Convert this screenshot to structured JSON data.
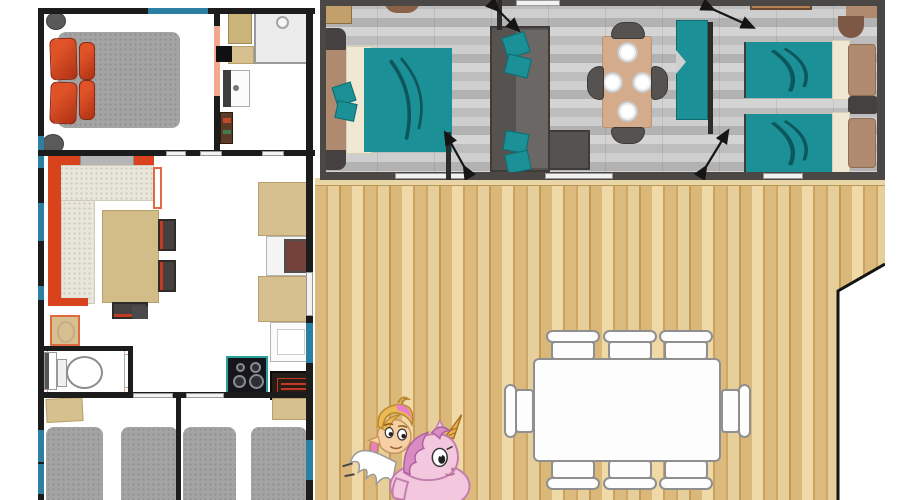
{
  "meta": {
    "type": "floor-plan",
    "subject": "mobile home / lodge floor plan with two units, wooden terrace and cartoon unicorn mascot",
    "visible_text": "none (tiny illegible red label on kitchen oven sign)"
  },
  "colors": {
    "wall": "#1c1c1c",
    "wall_gray": "#4b4744",
    "inner_wall": "#2e2c2a",
    "window_blue": "#2b7fa3",
    "salmon": "#f2a88e",
    "accent_orange": "#d8421c",
    "pillow_red": "#ae3114",
    "teal": "#1b9096",
    "teal_dark": "#0c565c",
    "beige": "#d6c08f",
    "beige_border": "#b7a06b",
    "tan_table": "#d4ac8c",
    "brown": "#b08a6e",
    "brown_dark": "#7d5844",
    "cream": "#f0e8d2",
    "sofa_gray": "#56524f",
    "furniture_dark": "#454140",
    "mattress_gray": "#a4a4a4",
    "cushion_light": "#e9e6dc",
    "steps_brown": "#b58255",
    "deck_mid": "#d9b87a",
    "unicorn_pink": "#f3c8de",
    "unicorn_mane": "#d98cc3",
    "hair_blonde": "#ecba54",
    "hair_pink": "#e87fc8",
    "skin": "#f6d0a4",
    "horn_gold": "#f0b358"
  },
  "floor_plan": {
    "left_unit": {
      "rooms": [
        {
          "name": "master bedroom",
          "furniture": [
            "double bed with red pillows",
            "2 round stools"
          ]
        },
        {
          "name": "shower room",
          "furniture": [
            "shower tray",
            "cabinet",
            "wash basin"
          ]
        },
        {
          "name": "living room",
          "furniture": [
            "orange corner sofa",
            "dining table",
            "3 chairs",
            "radiator"
          ]
        },
        {
          "name": "kitchen",
          "furniture": [
            "fridge",
            "worktop",
            "sink",
            "hob with 4 burners",
            "oven with red sign"
          ]
        },
        {
          "name": "wc",
          "furniture": [
            "toilet",
            "small basin"
          ]
        },
        {
          "name": "kids bedroom A",
          "furniture": [
            "2 single beds",
            "nightstand"
          ]
        },
        {
          "name": "kids bedroom B",
          "furniture": [
            "2 single beds",
            "nightstand"
          ]
        }
      ]
    },
    "right_unit": {
      "rooms": [
        {
          "name": "double bedroom",
          "furniture": [
            "double bed with teal cover",
            "2 nightstands",
            "dresser",
            "basin"
          ]
        },
        {
          "name": "lounge dining",
          "furniture": [
            "gray sofa with teal cushions",
            "side table",
            "dining table with 4 plates and 4 chairs",
            "teal wardrobe"
          ]
        },
        {
          "name": "twin bedroom",
          "furniture": [
            "2 single beds with teal covers",
            "nightstand",
            "basin",
            "outside step"
          ]
        }
      ],
      "door_swings": 4
    },
    "terrace": {
      "description": "large wooden deck with angled corner notch",
      "furniture": [
        "white rectangular table",
        "8 white chairs (3 top, 3 bottom, 1 left, 1 right)"
      ]
    },
    "mascot": "fairy girl with blonde-pink hair riding a pink winged unicorn"
  }
}
